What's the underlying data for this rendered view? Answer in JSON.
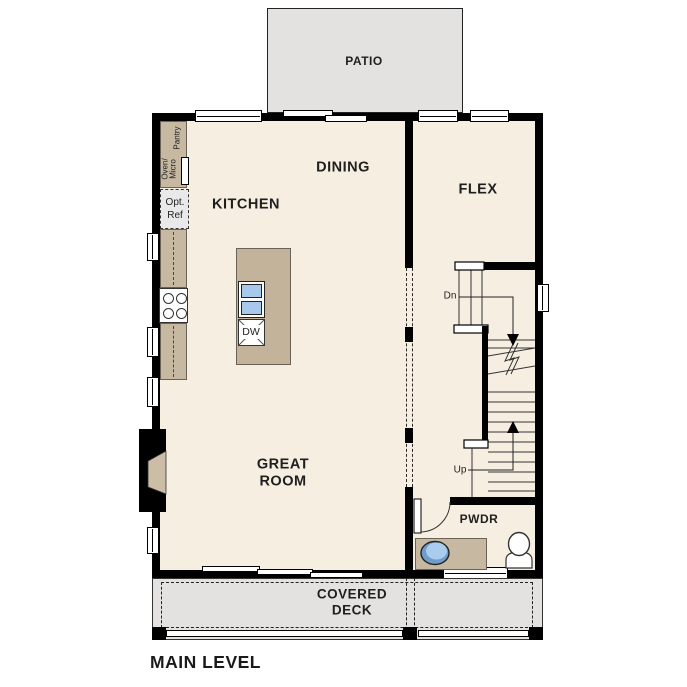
{
  "title": {
    "label": "MAIN LEVEL"
  },
  "rooms": {
    "patio": "PATIO",
    "dining": "DINING",
    "kitchen": "KITCHEN",
    "flex": "FLEX",
    "great_room": "GREAT\nROOM",
    "pwdr": "PWDR",
    "covered_deck": "COVERED\nDECK"
  },
  "fixtures": {
    "oven_micro": "Oven/\nMicro",
    "pantry": "Pantry",
    "opt_ref": "Opt.\nRef",
    "dishwasher": "DW"
  },
  "stairs": {
    "down_label": "Dn",
    "up_label": "Up"
  },
  "colors": {
    "floor": "#f6eee1",
    "walls": "#000000",
    "patio_deck": "#e3e2e0",
    "cabinets": "#c6b8a1",
    "sink_blue": "#a9c9ec",
    "optional_ref_gray": "#e9e9e9"
  }
}
